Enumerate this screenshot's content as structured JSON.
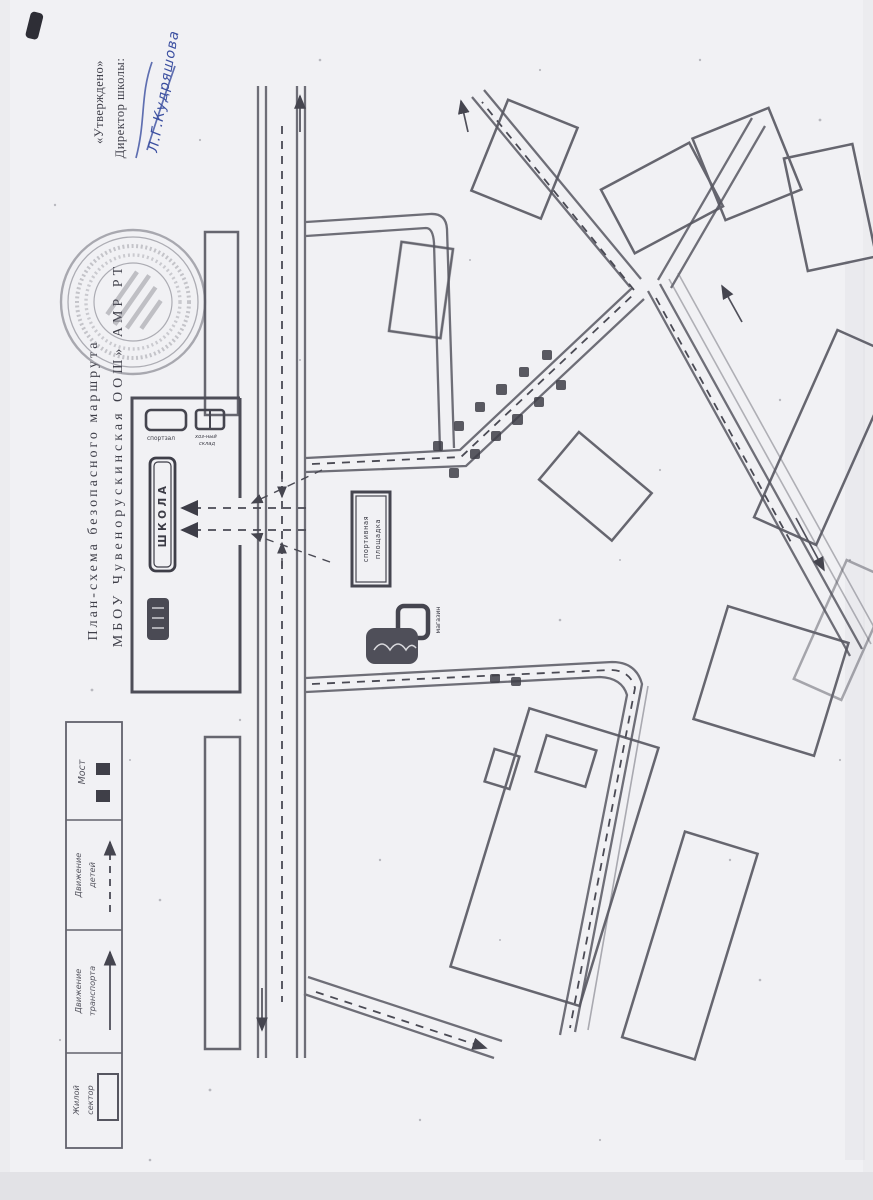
{
  "document": {
    "approval_line1": "«Утверждено»",
    "approval_line2": "Директор школы:",
    "signature": "Л.Г.Кудряшова",
    "title_line1": "План-схема безопасного маршрута",
    "title_line2": "МБОУ Чувенорускинская ООШ» АМР РТ"
  },
  "school_territory": {
    "school_label": "ШКОЛА",
    "gym_label": "спортзал",
    "shed_label_line1": "хоз-ный",
    "shed_label_line2": "склад"
  },
  "map": {
    "sports_ground_line1": "спортивная",
    "sports_ground_line2": "площадка",
    "store_label": "магазин"
  },
  "legend": {
    "bridge_label": "Мост",
    "children_line1": "Движение",
    "children_line2": "детей",
    "transport_line1": "Движение",
    "transport_line2": "транспорта",
    "housing_line1": "Жилой",
    "housing_line2": "сектор"
  },
  "colors": {
    "ink": "#3f3f49",
    "road": "#5a5a64",
    "signature_blue": "#3b4fa0",
    "paper": "#f1f1f4"
  }
}
